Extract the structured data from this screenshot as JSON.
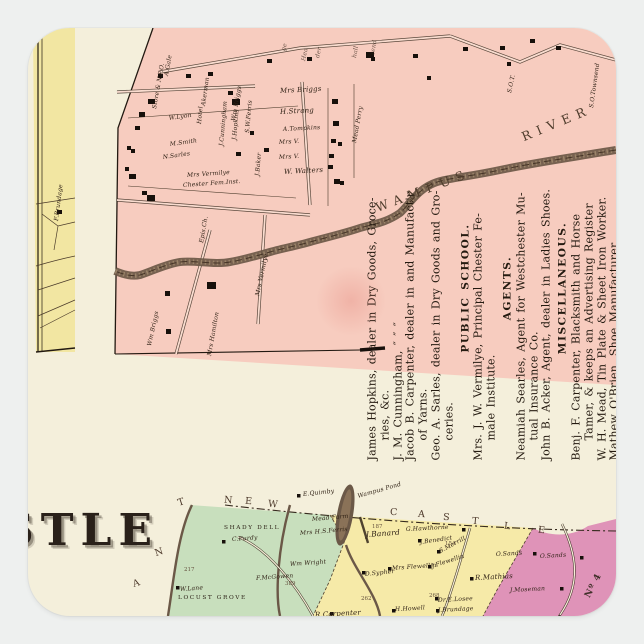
{
  "colors": {
    "page_bg": "#eef0ef",
    "sheet_cream": "#f4efdb",
    "village_pink": "#f7ccbf",
    "strip_yellow": "#f2e6a2",
    "township_green": "#c8dfbd",
    "township_yellow": "#f6eaa8",
    "township_magenta": "#df93b8",
    "river_brown": "#6b5847",
    "ink": "#241a10"
  },
  "village_map": {
    "river_label_wampus": "WAMPUS",
    "river_label_river": "RIVER",
    "labels": [
      {
        "t": "F.Brundage",
        "x": 29,
        "y": 190,
        "r": -83
      },
      {
        "t": "Store & N.P.O.",
        "x": 127,
        "y": 78,
        "r": -80
      },
      {
        "t": "A.Gale",
        "x": 139,
        "y": 45,
        "r": -80
      },
      {
        "t": "Akerman",
        "x": 176,
        "y": 75,
        "r": -82
      },
      {
        "t": "Wm Briggs",
        "x": 206,
        "y": 90,
        "r": -80
      },
      {
        "t": "ge",
        "x": 256,
        "y": 20,
        "r": -76,
        "k": "frag"
      },
      {
        "t": "Hea",
        "x": 276,
        "y": 30,
        "r": -78,
        "k": "frag"
      },
      {
        "t": "der",
        "x": 290,
        "y": 27,
        "r": -78,
        "k": "frag"
      },
      {
        "t": "hall",
        "x": 327,
        "y": 27,
        "r": -80,
        "k": "frag"
      },
      {
        "t": "send",
        "x": 345,
        "y": 24,
        "r": -80,
        "k": "frag"
      },
      {
        "t": "Hotel",
        "x": 172,
        "y": 93,
        "r": -85
      },
      {
        "t": "J.Cunningham",
        "x": 194,
        "y": 115,
        "r": -85
      },
      {
        "t": "S.W.Ferris",
        "x": 220,
        "y": 102,
        "r": -85
      },
      {
        "t": "J.Hopkins",
        "x": 207,
        "y": 109,
        "r": -85
      },
      {
        "t": "W.Lyon",
        "x": 141,
        "y": 88,
        "r": -8
      },
      {
        "t": "M.Smith",
        "x": 142,
        "y": 114,
        "r": -8
      },
      {
        "t": "N.Sarles",
        "x": 135,
        "y": 127,
        "r": -8
      },
      {
        "t": "Mrs Vermilye",
        "x": 159,
        "y": 145,
        "r": -4
      },
      {
        "t": "Chester Fem.Inst.",
        "x": 155,
        "y": 155,
        "r": -4
      },
      {
        "t": "J.Baker",
        "x": 230,
        "y": 145,
        "r": -85
      },
      {
        "t": "Mead Perry",
        "x": 327,
        "y": 112,
        "r": -80
      },
      {
        "t": "Mrs Briggs",
        "x": 252,
        "y": 60,
        "r": -3,
        "s": 7
      },
      {
        "t": "H.Strang",
        "x": 252,
        "y": 81,
        "r": -3,
        "s": 7
      },
      {
        "t": "A.Tompkins",
        "x": 255,
        "y": 99,
        "r": -3
      },
      {
        "t": "Mrs V.",
        "x": 251,
        "y": 112,
        "r": -3
      },
      {
        "t": "Mrs V.",
        "x": 251,
        "y": 127,
        "r": -3
      },
      {
        "t": "W. Walters",
        "x": 256,
        "y": 141,
        "r": -3,
        "s": 7
      },
      {
        "t": "S.O.Townsend",
        "x": 564,
        "y": 77,
        "r": -82
      },
      {
        "t": "S.O.T.",
        "x": 482,
        "y": 62,
        "r": -78
      },
      {
        "t": "Wm Briggs",
        "x": 122,
        "y": 315,
        "r": -78
      },
      {
        "t": "Mrs Hamilton",
        "x": 182,
        "y": 325,
        "r": -80
      },
      {
        "t": "Mrs Vermilye",
        "x": 230,
        "y": 265,
        "r": -78
      },
      {
        "t": "Epis.Ch.",
        "x": 174,
        "y": 212,
        "r": -80
      }
    ]
  },
  "directory": {
    "lines": [
      {
        "t": "James Hopkins, dealer in Dry Goods, Groce-",
        "s": "f"
      },
      {
        "t": "ries, &c.",
        "s": "i"
      },
      {
        "t": "J. M. Cunningham,  ″      ″      ″",
        "s": "f"
      },
      {
        "t": "Jacob B. Carpenter, dealer in and Manufact'r",
        "s": "f"
      },
      {
        "t": "of Yarns.",
        "s": "i"
      },
      {
        "t": "Geo. A. Sarles, dealer in Dry Goods and Gro-",
        "s": "f"
      },
      {
        "t": "ceries.",
        "s": "i"
      },
      {
        "t": "PUBLIC SCHOOL.",
        "s": "h"
      },
      {
        "t": "Mrs. J. W. Vermilye, Principal Chester Fe-",
        "s": "f"
      },
      {
        "t": "male Institute.",
        "s": "i"
      },
      {
        "t": "AGENTS.",
        "s": "h"
      },
      {
        "t": "Neamiah Searles, Agent for Westchester Mu-",
        "s": "f"
      },
      {
        "t": "tual Insurance Co.",
        "s": "i"
      },
      {
        "t": "John B. Acker, Agent, dealer in Ladies Shoes.",
        "s": "f"
      },
      {
        "t": "MISCELLANEOUS.",
        "s": "h"
      },
      {
        "t": "Benj. F. Carpenter, Blacksmith and Horse",
        "s": "f"
      },
      {
        "t": "Tamer, & keeps an Advertising Register",
        "s": "i"
      },
      {
        "t": "W. H. Mead, Tin Plate & Sheet Iron Worker.",
        "s": "f"
      },
      {
        "t": "Mathew O'Brien, Shoe Manufacturer.",
        "s": "f"
      },
      {
        "t": "John Sherwood,  ″       ″",
        "s": "f"
      }
    ]
  },
  "township_map": {
    "title_fragment": "STLE",
    "boundary_letters": [
      {
        "t": "N",
        "x": 196,
        "y": 468,
        "r": 5
      },
      {
        "t": "E",
        "x": 217,
        "y": 469,
        "r": 5
      },
      {
        "t": "W",
        "x": 240,
        "y": 472,
        "r": 6
      },
      {
        "t": "C",
        "x": 362,
        "y": 480,
        "r": 4
      },
      {
        "t": "A",
        "x": 390,
        "y": 482,
        "r": 4
      },
      {
        "t": "S",
        "x": 415,
        "y": 485,
        "r": 5
      },
      {
        "t": "T",
        "x": 444,
        "y": 489,
        "r": 5
      },
      {
        "t": "L",
        "x": 476,
        "y": 494,
        "r": 6
      },
      {
        "t": "E",
        "x": 510,
        "y": 498,
        "r": 6
      },
      {
        "t": "T",
        "x": 150,
        "y": 470,
        "r": -18
      },
      {
        "t": "N",
        "x": 127,
        "y": 520,
        "r": -18
      },
      {
        "t": "A",
        "x": 105,
        "y": 551,
        "r": -18
      }
    ],
    "labels": [
      {
        "t": "E.Quimby",
        "x": 275,
        "y": 464,
        "r": -6
      },
      {
        "t": "Wampus Pond",
        "x": 330,
        "y": 466,
        "r": -16
      },
      {
        "t": "Mead Farm",
        "x": 284,
        "y": 489,
        "r": -5
      },
      {
        "t": "Mrs H.S.Ferris",
        "x": 272,
        "y": 503,
        "r": -5
      },
      {
        "t": "SHADY DELL",
        "x": 196,
        "y": 498,
        "k": "caps"
      },
      {
        "t": "C.Purdy",
        "x": 204,
        "y": 509,
        "r": -4
      },
      {
        "t": "Wm Wright",
        "x": 262,
        "y": 534,
        "r": -4
      },
      {
        "t": "F.McGowen",
        "x": 228,
        "y": 548,
        "r": -4
      },
      {
        "t": "W.Lane",
        "x": 152,
        "y": 559,
        "r": -4
      },
      {
        "t": "LOCUST GROVE",
        "x": 150,
        "y": 568,
        "k": "caps"
      },
      {
        "t": "J.Banard",
        "x": 338,
        "y": 503,
        "r": -4,
        "s": 7.5
      },
      {
        "t": "G.Hawthorne",
        "x": 378,
        "y": 499,
        "r": -3
      },
      {
        "t": "J.Benedict",
        "x": 392,
        "y": 512,
        "r": -8
      },
      {
        "t": "S.Merrill",
        "x": 412,
        "y": 521,
        "r": -28
      },
      {
        "t": "J.Flewellin",
        "x": 404,
        "y": 536,
        "r": -18
      },
      {
        "t": "Mrs Flewellin",
        "x": 364,
        "y": 538,
        "r": -4
      },
      {
        "t": "O.Sands",
        "x": 468,
        "y": 524,
        "r": -3
      },
      {
        "t": "O.Sands",
        "x": 512,
        "y": 526,
        "r": -3
      },
      {
        "t": "R.Mathias",
        "x": 447,
        "y": 547,
        "r": -3,
        "s": 7
      },
      {
        "t": "J.Moseman",
        "x": 482,
        "y": 560,
        "r": -3
      },
      {
        "t": "D.Sypher",
        "x": 337,
        "y": 544,
        "r": -6
      },
      {
        "t": "R.Carpenter",
        "x": 287,
        "y": 584,
        "r": -3,
        "s": 7
      },
      {
        "t": "H.Howell",
        "x": 367,
        "y": 579,
        "r": -3
      },
      {
        "t": "Dr.E.Losee",
        "x": 410,
        "y": 570,
        "r": -3
      },
      {
        "t": "J.Brundage",
        "x": 410,
        "y": 580,
        "r": -3
      },
      {
        "t": "217",
        "x": 156,
        "y": 540,
        "k": "num"
      },
      {
        "t": "389",
        "x": 257,
        "y": 554,
        "k": "num"
      },
      {
        "t": "187",
        "x": 344,
        "y": 497,
        "k": "num"
      },
      {
        "t": "154",
        "x": 417,
        "y": 514,
        "k": "num"
      },
      {
        "t": "262",
        "x": 333,
        "y": 569,
        "k": "num"
      },
      {
        "t": "268",
        "x": 401,
        "y": 566,
        "k": "num"
      },
      {
        "t": "Nº 4",
        "x": 560,
        "y": 565,
        "r": -62,
        "k": "dist"
      }
    ]
  }
}
